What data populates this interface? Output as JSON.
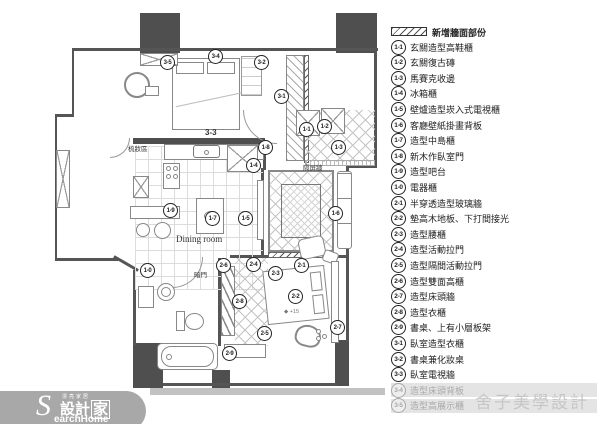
{
  "legend": {
    "header": {
      "label": "新增牆面部份"
    },
    "items": [
      {
        "code": "1-1",
        "label": "玄關造型高鞋櫃",
        "muted": false
      },
      {
        "code": "1-2",
        "label": "玄關復古磚",
        "muted": false
      },
      {
        "code": "1-3",
        "label": "馬賽克收邊",
        "muted": false
      },
      {
        "code": "1-4",
        "label": "冰箱櫃",
        "muted": false
      },
      {
        "code": "1-5",
        "label": "壁爐造型崁入式電視櫃",
        "muted": false
      },
      {
        "code": "1-6",
        "label": "客廳壁紙掛畫背板",
        "muted": false
      },
      {
        "code": "1-7",
        "label": "造型中島櫃",
        "muted": false
      },
      {
        "code": "1-8",
        "label": "新木作臥室門",
        "muted": false
      },
      {
        "code": "1-9",
        "label": "造型吧台",
        "muted": false
      },
      {
        "code": "1-0",
        "label": "電器櫃",
        "muted": false
      },
      {
        "code": "2-1",
        "label": "半穿透造型玻璃牆",
        "muted": false
      },
      {
        "code": "2-2",
        "label": "墊高木地板、下打間接光",
        "muted": false
      },
      {
        "code": "2-3",
        "label": "造型腰櫃",
        "muted": false
      },
      {
        "code": "2-4",
        "label": "造型活動拉門",
        "muted": false
      },
      {
        "code": "2-5",
        "label": "造型隔間活動拉門",
        "muted": false
      },
      {
        "code": "2-6",
        "label": "造型雙面高櫃",
        "muted": false
      },
      {
        "code": "2-7",
        "label": "造型床頭牆",
        "muted": false
      },
      {
        "code": "2-8",
        "label": "造型衣櫃",
        "muted": false
      },
      {
        "code": "2-9",
        "label": "書桌、上有小層板架",
        "muted": false
      },
      {
        "code": "3-1",
        "label": "臥室造型衣櫃",
        "muted": false
      },
      {
        "code": "3-2",
        "label": "書桌兼化妝桌",
        "muted": false
      },
      {
        "code": "3-3",
        "label": "臥室電視牆",
        "muted": false
      },
      {
        "code": "3-4",
        "label": "造型床頭背板",
        "muted": true
      },
      {
        "code": "3-5",
        "label": "造型高展示櫃",
        "muted": true
      }
    ]
  },
  "plan": {
    "markers": [
      {
        "code": "3-5",
        "x": 167,
        "y": 62
      },
      {
        "code": "3-4",
        "x": 215,
        "y": 56
      },
      {
        "code": "3-2",
        "x": 261,
        "y": 62
      },
      {
        "code": "3-1",
        "x": 281,
        "y": 96
      },
      {
        "code": "1-1",
        "x": 306,
        "y": 129
      },
      {
        "code": "1-2",
        "x": 324,
        "y": 126
      },
      {
        "code": "1-3",
        "x": 338,
        "y": 147
      },
      {
        "code": "1-8",
        "x": 265,
        "y": 147
      },
      {
        "code": "1-4",
        "x": 253,
        "y": 165
      },
      {
        "code": "1-9",
        "x": 170,
        "y": 210
      },
      {
        "code": "1-7",
        "x": 212,
        "y": 218
      },
      {
        "code": "1-5",
        "x": 245,
        "y": 218
      },
      {
        "code": "1-6",
        "x": 335,
        "y": 213
      },
      {
        "code": "1-0",
        "x": 147,
        "y": 270
      },
      {
        "code": "2-6",
        "x": 223,
        "y": 265
      },
      {
        "code": "2-4",
        "x": 253,
        "y": 264
      },
      {
        "code": "2-3",
        "x": 275,
        "y": 273
      },
      {
        "code": "2-1",
        "x": 301,
        "y": 265
      },
      {
        "code": "2-8",
        "x": 239,
        "y": 301
      },
      {
        "code": "2-2",
        "x": 295,
        "y": 296
      },
      {
        "code": "2-5",
        "x": 264,
        "y": 333
      },
      {
        "code": "2-7",
        "x": 337,
        "y": 327
      },
      {
        "code": "2-9",
        "x": 229,
        "y": 353
      }
    ],
    "labels": {
      "tv_wall": "3-3",
      "dining_room": "Dining room",
      "dressing_area": "梳妝區",
      "screen_wall": "隔屏牆",
      "hidden_door": "暗門",
      "floor_height_icon": "◆",
      "floor_height": "+15"
    }
  },
  "watermark": {
    "text": "舍子美學設計"
  },
  "logo": {
    "tagline": "漂亮家居",
    "s": "S",
    "zh1": "設計",
    "zh2": "家",
    "en": "earchHome"
  },
  "colors": {
    "column": "#4f4f4f",
    "wall": "#555555",
    "legend_text": "#222222",
    "muted": "#a9a9a9",
    "watermark": "#c6c6c6",
    "logo_bg": "#a8a8a8"
  }
}
